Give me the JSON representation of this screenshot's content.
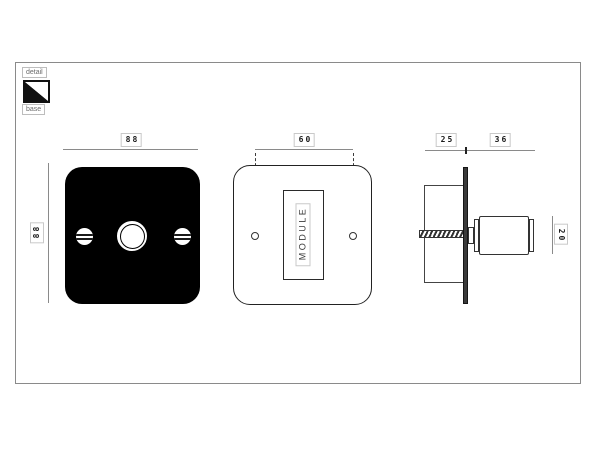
{
  "legend": {
    "detail_label": "detail",
    "base_label": "base"
  },
  "views": {
    "front_base": {
      "width_dim": "88",
      "height_dim": "88"
    },
    "front_detail": {
      "hole_spacing_dim": "60",
      "module_label": "MODULE"
    },
    "side": {
      "box_depth_dim": "25",
      "knob_projection_dim": "36",
      "knob_diameter_dim": "20"
    }
  },
  "colors": {
    "plate_fill": "#000000",
    "dimension_line": "#8a8a8a",
    "outline_ink": "#333333",
    "chip_border": "#c9c9c9",
    "chip_text": "#1a1a1a",
    "legend_text": "#6b6b6b"
  }
}
